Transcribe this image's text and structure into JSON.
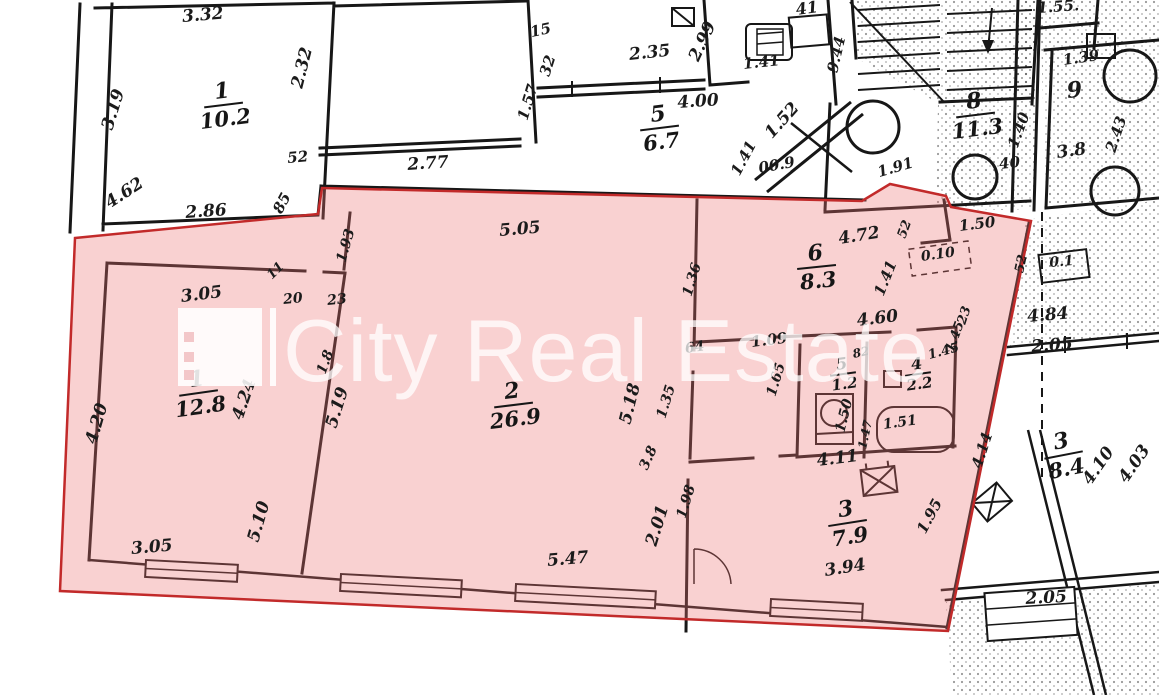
{
  "watermark": {
    "text": "City Real Estate"
  },
  "colors": {
    "highlight_fill": "#ec7373",
    "highlight_border": "#c22a2a",
    "wall": "#171717",
    "paper": "#ffffff"
  },
  "highlighted_apartment": {
    "rooms": [
      {
        "number": "1",
        "area": "12.8",
        "x": 173,
        "y": 368,
        "rot": -8
      },
      {
        "number": "2",
        "area": "26.9",
        "x": 488,
        "y": 380,
        "rot": -7
      },
      {
        "number": "3",
        "area": "7.9",
        "x": 828,
        "y": 498,
        "rot": -9
      },
      {
        "number": "4",
        "area": "2.2",
        "x": 905,
        "y": 356,
        "rot": -8,
        "small": true
      },
      {
        "number": "5",
        "area": "1.2",
        "x": 830,
        "y": 356,
        "rot": -8,
        "small": true
      },
      {
        "number": "6",
        "area": "8.3",
        "x": 797,
        "y": 242,
        "rot": -6
      }
    ]
  },
  "other_rooms": [
    {
      "number": "1",
      "area": "10.2",
      "x": 198,
      "y": 80,
      "rot": -7
    },
    {
      "number": "5",
      "area": "6.7",
      "x": 640,
      "y": 103,
      "rot": -7
    },
    {
      "number": "8",
      "area": "11.3",
      "x": 950,
      "y": 90,
      "rot": -7
    },
    {
      "number": "3",
      "area": "8.4",
      "x": 1044,
      "y": 430,
      "rot": -11
    }
  ],
  "dimensions": [
    {
      "t": "3.32",
      "x": 183,
      "y": 26,
      "r": -5
    },
    {
      "t": "3.19",
      "x": 116,
      "y": 132,
      "r": -73
    },
    {
      "t": "2.32",
      "x": 306,
      "y": 90,
      "r": -76
    },
    {
      "t": "4.62",
      "x": 112,
      "y": 212,
      "r": -33
    },
    {
      "t": "2.86",
      "x": 186,
      "y": 222,
      "r": -4
    },
    {
      "t": "52",
      "x": 288,
      "y": 166,
      "r": -5,
      "s": 15
    },
    {
      "t": "85",
      "x": 284,
      "y": 216,
      "r": -62,
      "s": 15
    },
    {
      "t": "2.77",
      "x": 408,
      "y": 174,
      "r": -4
    },
    {
      "t": "15",
      "x": 532,
      "y": 40,
      "r": -12,
      "s": 15
    },
    {
      "t": "32",
      "x": 552,
      "y": 78,
      "r": -72,
      "s": 15
    },
    {
      "t": "1.57",
      "x": 530,
      "y": 122,
      "r": -73,
      "s": 15
    },
    {
      "t": "2.35",
      "x": 630,
      "y": 64,
      "r": -6
    },
    {
      "t": "2.99",
      "x": 702,
      "y": 64,
      "r": -65
    },
    {
      "t": "4.00",
      "x": 678,
      "y": 112,
      "r": -4
    },
    {
      "t": "1.41",
      "x": 744,
      "y": 72,
      "r": -6,
      "s": 15
    },
    {
      "t": "41",
      "x": 797,
      "y": 18,
      "r": -8,
      "s": 16
    },
    {
      "t": "1.52",
      "x": 775,
      "y": 142,
      "r": -48
    },
    {
      "t": "1.41",
      "x": 742,
      "y": 178,
      "r": -62,
      "s": 15
    },
    {
      "t": "00.9",
      "x": 760,
      "y": 176,
      "r": -10,
      "s": 15
    },
    {
      "t": "1.91",
      "x": 880,
      "y": 180,
      "r": -16,
      "s": 15
    },
    {
      "t": "9.44",
      "x": 840,
      "y": 74,
      "r": -77,
      "s": 15
    },
    {
      "t": "1.55.",
      "x": 1038,
      "y": 16,
      "r": -4,
      "s": 15
    },
    {
      "t": "1.39",
      "x": 1064,
      "y": 68,
      "r": -8,
      "s": 15
    },
    {
      "t": "9",
      "x": 1068,
      "y": 102,
      "r": -6,
      "s": 22
    },
    {
      "t": "1.40",
      "x": 1020,
      "y": 150,
      "r": -70,
      "s": 15
    },
    {
      "t": "3.8",
      "x": 1058,
      "y": 162,
      "r": -8,
      "s": 17
    },
    {
      "t": "2.43",
      "x": 1118,
      "y": 154,
      "r": -72,
      "s": 15
    },
    {
      "t": "40",
      "x": 1000,
      "y": 172,
      "r": -6,
      "s": 15
    },
    {
      "t": "52",
      "x": 908,
      "y": 240,
      "r": -70,
      "s": 13
    },
    {
      "t": "1.50",
      "x": 960,
      "y": 234,
      "r": -7,
      "s": 15
    },
    {
      "t": "0.10",
      "x": 922,
      "y": 264,
      "r": -8,
      "s": 14
    },
    {
      "t": "52",
      "x": 1026,
      "y": 274,
      "r": -78,
      "s": 13
    },
    {
      "t": "0.1",
      "x": 1050,
      "y": 270,
      "r": -5,
      "s": 14
    },
    {
      "t": "4.84",
      "x": 1028,
      "y": 326,
      "r": -5
    },
    {
      "t": "2.05",
      "x": 1032,
      "y": 356,
      "r": -4
    },
    {
      "t": "23",
      "x": 968,
      "y": 326,
      "r": -72,
      "s": 13
    },
    {
      "t": "1.45",
      "x": 956,
      "y": 354,
      "r": -70,
      "s": 13
    },
    {
      "t": "4.14",
      "x": 984,
      "y": 470,
      "r": -72,
      "s": 15
    },
    {
      "t": "4.10",
      "x": 1094,
      "y": 488,
      "r": -55
    },
    {
      "t": "4.03",
      "x": 1130,
      "y": 486,
      "r": -55
    },
    {
      "t": "2.05",
      "x": 1026,
      "y": 608,
      "r": -3
    },
    {
      "t": "3.05",
      "x": 182,
      "y": 306,
      "r": -7
    },
    {
      "t": "4.20",
      "x": 100,
      "y": 446,
      "r": -74
    },
    {
      "t": "4.24",
      "x": 246,
      "y": 422,
      "r": -71
    },
    {
      "t": "11",
      "x": 274,
      "y": 282,
      "r": -45,
      "s": 13
    },
    {
      "t": "20",
      "x": 284,
      "y": 307,
      "r": -6,
      "s": 14
    },
    {
      "t": "23",
      "x": 328,
      "y": 308,
      "r": -6,
      "s": 14
    },
    {
      "t": "1.93",
      "x": 348,
      "y": 264,
      "r": -74,
      "s": 14
    },
    {
      "t": "1.8",
      "x": 328,
      "y": 376,
      "r": -70,
      "s": 14
    },
    {
      "t": "5.19",
      "x": 340,
      "y": 430,
      "r": -73
    },
    {
      "t": "5.05",
      "x": 500,
      "y": 240,
      "r": -5
    },
    {
      "t": "5.18",
      "x": 634,
      "y": 426,
      "r": -76
    },
    {
      "t": "1.35",
      "x": 668,
      "y": 420,
      "r": -73,
      "s": 14
    },
    {
      "t": "1.36",
      "x": 694,
      "y": 298,
      "r": -73,
      "s": 14
    },
    {
      "t": "4.72",
      "x": 840,
      "y": 248,
      "r": -9
    },
    {
      "t": "1.41",
      "x": 886,
      "y": 298,
      "r": -68,
      "s": 15
    },
    {
      "t": "4.60",
      "x": 858,
      "y": 330,
      "r": -7
    },
    {
      "t": "64",
      "x": 686,
      "y": 356,
      "r": -8,
      "s": 14
    },
    {
      "t": "1.09",
      "x": 752,
      "y": 350,
      "r": -7,
      "s": 15
    },
    {
      "t": "1.65",
      "x": 778,
      "y": 398,
      "r": -73,
      "s": 14
    },
    {
      "t": "82",
      "x": 854,
      "y": 360,
      "r": -12,
      "s": 12
    },
    {
      "t": "1.50",
      "x": 847,
      "y": 434,
      "r": -76,
      "s": 14
    },
    {
      "t": "1.45",
      "x": 930,
      "y": 362,
      "r": -15,
      "s": 13
    },
    {
      "t": "1.51",
      "x": 884,
      "y": 432,
      "r": -8,
      "s": 14
    },
    {
      "t": "1.47",
      "x": 868,
      "y": 450,
      "r": -78,
      "s": 12
    },
    {
      "t": "4.11",
      "x": 818,
      "y": 470,
      "r": -7
    },
    {
      "t": "1.95",
      "x": 928,
      "y": 536,
      "r": -62,
      "s": 15
    },
    {
      "t": "3.94",
      "x": 826,
      "y": 580,
      "r": -9
    },
    {
      "t": "3.8",
      "x": 650,
      "y": 472,
      "r": -66,
      "s": 14
    },
    {
      "t": "2.01",
      "x": 660,
      "y": 548,
      "r": -73
    },
    {
      "t": "1.98",
      "x": 688,
      "y": 520,
      "r": -73,
      "s": 14
    },
    {
      "t": "5.47",
      "x": 548,
      "y": 570,
      "r": -5
    },
    {
      "t": "5.10",
      "x": 262,
      "y": 544,
      "r": -74
    },
    {
      "t": "3.05",
      "x": 132,
      "y": 558,
      "r": -5
    }
  ]
}
